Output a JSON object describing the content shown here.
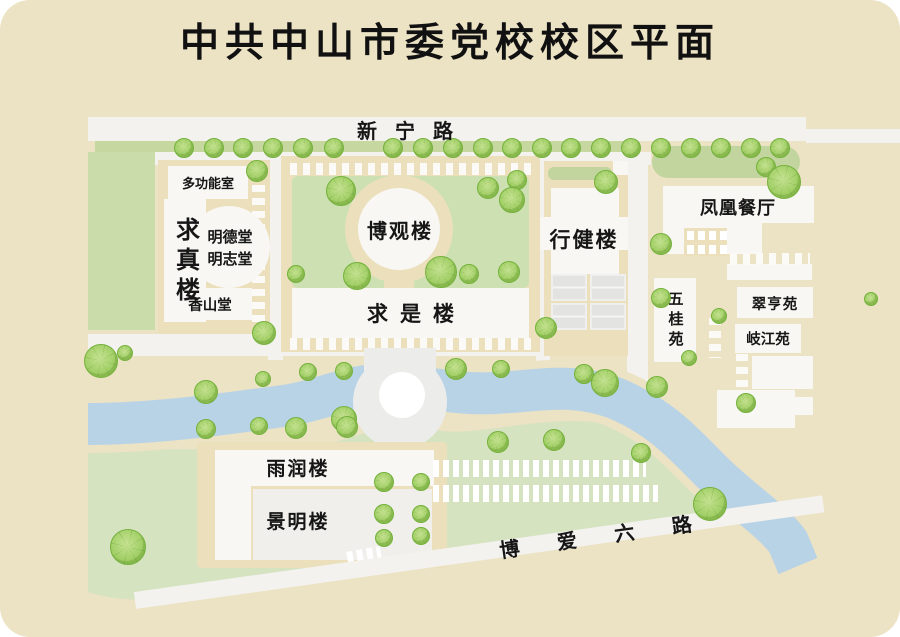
{
  "title": "中共中山市委党校校区平面",
  "roads": {
    "xinning": "新宁路",
    "boai": "博爱六路"
  },
  "buildings": {
    "duogongneng": "多功能室",
    "qiuzhen": "求真楼",
    "mingde": "明德堂",
    "mingzhi": "明志堂",
    "xiangshan": "香山堂",
    "boguan": "博观楼",
    "qiushi": "求是楼",
    "xingjian": "行健楼",
    "fenghuang": "凤凰餐厅",
    "wugui": "五桂苑",
    "cuiheng": "翠亨苑",
    "qijiang": "岐江苑",
    "yurun": "雨润楼",
    "jingming": "景明楼"
  },
  "colors": {
    "background": "#ece2c4",
    "road_white": "#f3f2ef",
    "building_white": "#f8f7f4",
    "block_tan": "#ebdfbc",
    "lawn_green": "#cde0b1",
    "lower_green": "#d6e3c1",
    "river_blue": "#b9d3e6",
    "court_gray": "#e3e3e1",
    "tree_green": "#a3d068",
    "text": "#161616"
  },
  "street_trees": {
    "y": 147,
    "r": 9,
    "x": [
      183,
      213,
      242,
      272,
      302,
      333,
      392,
      422,
      452,
      482,
      511,
      541,
      570,
      600,
      630,
      660,
      690,
      720,
      750,
      779
    ]
  },
  "trees": [
    [
      256,
      170,
      10
    ],
    [
      340,
      190,
      14
    ],
    [
      487,
      187,
      10
    ],
    [
      516,
      179,
      9
    ],
    [
      511,
      199,
      12
    ],
    [
      295,
      273,
      8
    ],
    [
      356,
      275,
      13
    ],
    [
      440,
      271,
      15
    ],
    [
      468,
      273,
      9
    ],
    [
      508,
      271,
      10
    ],
    [
      605,
      181,
      11
    ],
    [
      545,
      327,
      10
    ],
    [
      583,
      373,
      9
    ],
    [
      604,
      382,
      13
    ],
    [
      660,
      297,
      9
    ],
    [
      688,
      357,
      7
    ],
    [
      718,
      315,
      7
    ],
    [
      870,
      298,
      6
    ],
    [
      765,
      166,
      9
    ],
    [
      783,
      181,
      16
    ],
    [
      660,
      243,
      10
    ],
    [
      745,
      402,
      9
    ],
    [
      100,
      360,
      16
    ],
    [
      124,
      352,
      7
    ],
    [
      205,
      391,
      11
    ],
    [
      263,
      332,
      11
    ],
    [
      262,
      378,
      7
    ],
    [
      307,
      371,
      8
    ],
    [
      343,
      370,
      8
    ],
    [
      343,
      418,
      12
    ],
    [
      455,
      368,
      10
    ],
    [
      500,
      368,
      8
    ],
    [
      497,
      441,
      10
    ],
    [
      553,
      439,
      10
    ],
    [
      640,
      452,
      9
    ],
    [
      656,
      386,
      10
    ],
    [
      709,
      503,
      16
    ],
    [
      127,
      546,
      17
    ],
    [
      383,
      481,
      9
    ],
    [
      420,
      481,
      8
    ],
    [
      383,
      513,
      9
    ],
    [
      420,
      513,
      8
    ],
    [
      383,
      537,
      8
    ],
    [
      420,
      535,
      8
    ],
    [
      205,
      428,
      9
    ],
    [
      258,
      425,
      8
    ],
    [
      295,
      427,
      10
    ],
    [
      346,
      426,
      10
    ]
  ]
}
